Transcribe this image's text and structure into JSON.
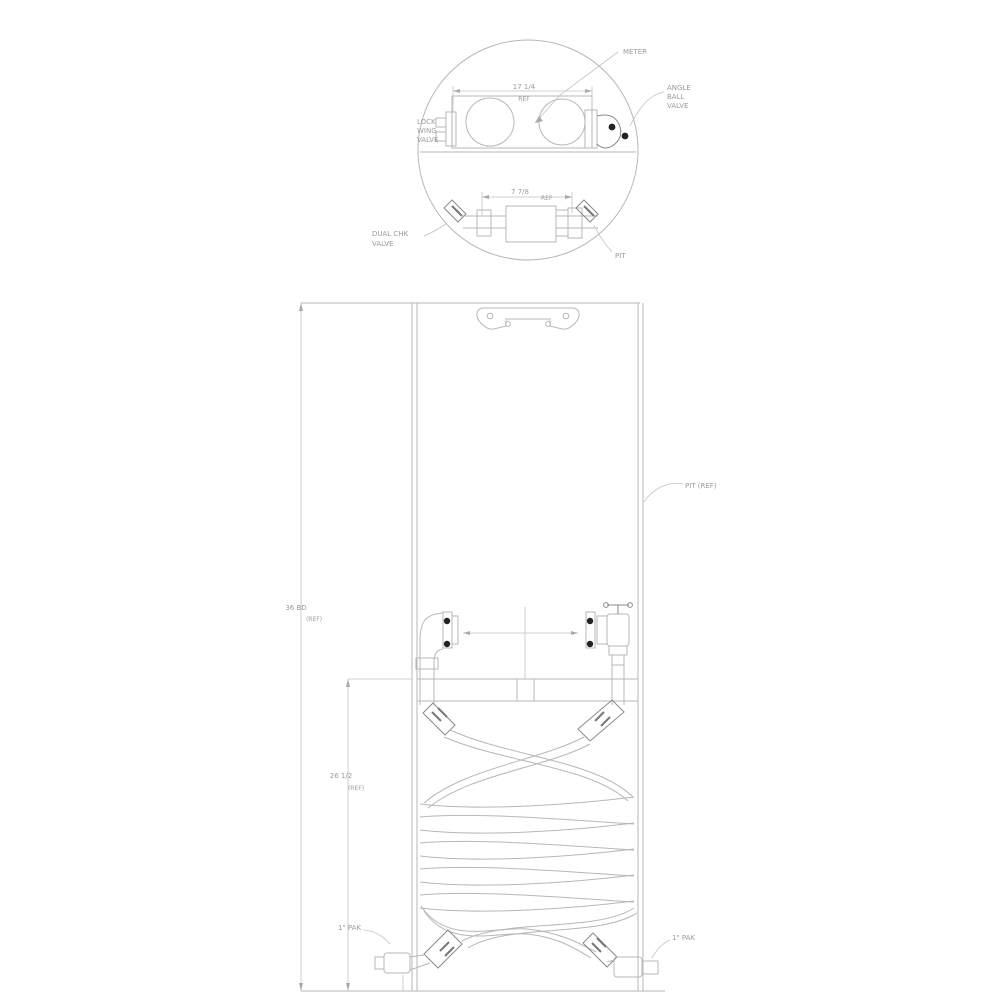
{
  "diagram": {
    "colors": {
      "background": "#ffffff",
      "line": "#b7b7b7",
      "line_dark": "#8a8a8a",
      "bolt_dot": "#222222",
      "text": "#9b9b9b"
    },
    "top_view": {
      "meter_label": "METER",
      "valve_label_1": "ANGLE",
      "valve_label_2": "BALL",
      "valve_label_3": "VALVE",
      "inlet_label_1": "LOCK",
      "inlet_label_2": "WING",
      "inlet_label_3": "VALVE",
      "check_label_1": "DUAL CHK",
      "check_label_2": "VALVE",
      "pit_label": "PIT",
      "width_dim": "17 1/4",
      "width_dim_ref": "REF",
      "meter_dim": "7 7/8",
      "meter_dim_ref": "REF"
    },
    "elevation": {
      "pit_label": "PIT (REF)",
      "height_dim": "36 BD",
      "height_dim_ref": "(REF)",
      "coil_dim": "26 1/2",
      "coil_dim_ref": "(REF)",
      "left_outlet_label": "1\" PAK",
      "right_outlet_label": "1\" PAK"
    }
  }
}
